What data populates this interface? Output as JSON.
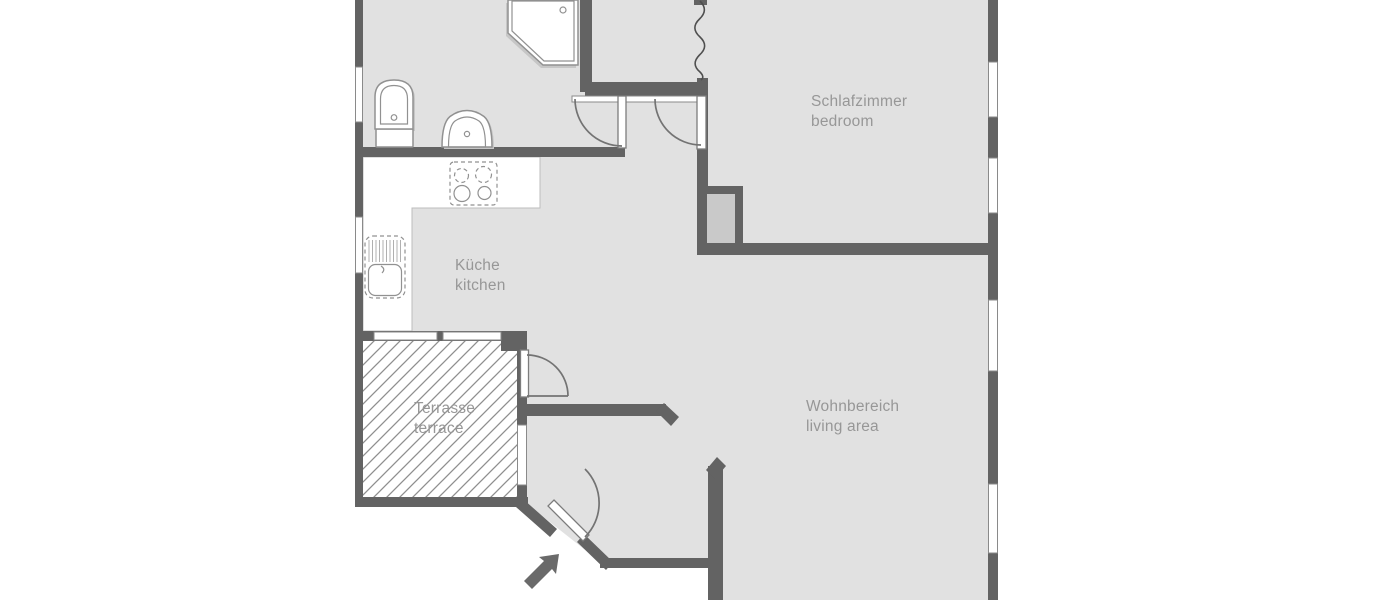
{
  "plan": {
    "type": "apartment-floor-plan",
    "rooms": [
      {
        "id": "bedroom",
        "label_de": "Schlafzimmer",
        "label_en": "bedroom"
      },
      {
        "id": "kitchen",
        "label_de": "Küche",
        "label_en": "kitchen"
      },
      {
        "id": "living-area",
        "label_de": "Wohnbereich",
        "label_en": "living area"
      },
      {
        "id": "terrace",
        "label_de": "Terrasse",
        "label_en": "terrace"
      }
    ],
    "fixtures": [
      "shower",
      "toilet",
      "washbasin",
      "stove",
      "kitchen-sink"
    ],
    "symbols": [
      "door-swing-arc",
      "window",
      "entrance-arrow",
      "wall-break-line",
      "chimney-shaft",
      "terrace-hatching"
    ],
    "colors": {
      "background": "#ffffff",
      "floor": "#e1e1e1",
      "wall": "#636363",
      "window_fill": "#ffffff",
      "chimney_fill": "#c9c9c9",
      "hatch_line": "#8f8f8f",
      "label_text": "#979797",
      "fixture_stroke": "#919191",
      "door_arc": "#737373",
      "arrow": "#6a6a6a"
    }
  }
}
